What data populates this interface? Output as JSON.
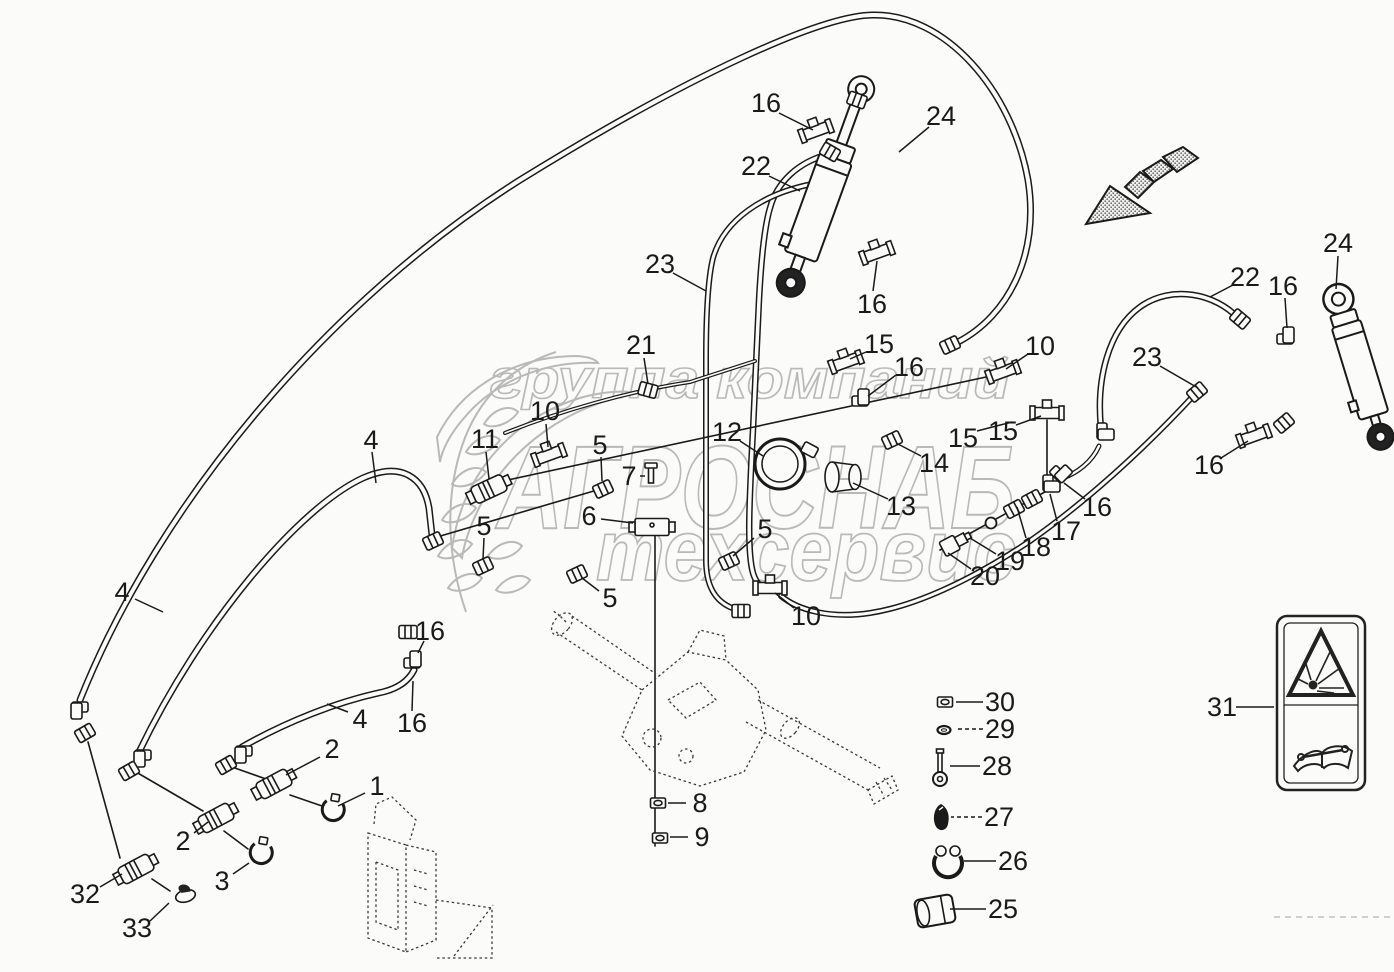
{
  "watermark": {
    "line1": "группа компаний",
    "line2": "АГРОСНАБ",
    "line3": "техсервис"
  },
  "colors": {
    "line": "#1a1a1a",
    "watermark": "#b9b9b6",
    "background": "#fbfbf9",
    "reference_dash": "#3a3a3a"
  },
  "icons": {
    "direction_arrow": "striped-direction-arrow",
    "sticker_top": "explosion-warning-triangle",
    "sticker_bottom": "read-operator-manual-book"
  },
  "callouts": [
    {
      "n": "16",
      "x": 766,
      "y": 103,
      "lx1": 779,
      "ly1": 113,
      "lx2": 813,
      "ly2": 130
    },
    {
      "n": "24",
      "x": 941,
      "y": 116,
      "lx1": 929,
      "ly1": 127,
      "lx2": 899,
      "ly2": 152
    },
    {
      "n": "22",
      "x": 756,
      "y": 166,
      "lx1": 769,
      "ly1": 176,
      "lx2": 800,
      "ly2": 191
    },
    {
      "n": "16",
      "x": 872,
      "y": 304,
      "lx1": 873,
      "ly1": 291,
      "lx2": 877,
      "ly2": 261
    },
    {
      "n": "23",
      "x": 660,
      "y": 264,
      "lx1": 673,
      "ly1": 273,
      "lx2": 706,
      "ly2": 291
    },
    {
      "n": "21",
      "x": 641,
      "y": 345,
      "lx1": 644,
      "ly1": 358,
      "lx2": 648,
      "ly2": 384
    },
    {
      "n": "24",
      "x": 1338,
      "y": 243,
      "lx1": 1338,
      "ly1": 256,
      "lx2": 1336,
      "ly2": 289
    },
    {
      "n": "22",
      "x": 1245,
      "y": 277,
      "lx1": 1233,
      "ly1": 285,
      "lx2": 1210,
      "ly2": 297
    },
    {
      "n": "16",
      "x": 1283,
      "y": 286,
      "lx1": 1285,
      "ly1": 298,
      "lx2": 1287,
      "ly2": 328
    },
    {
      "n": "23",
      "x": 1147,
      "y": 357,
      "lx1": 1160,
      "ly1": 366,
      "lx2": 1198,
      "ly2": 388
    },
    {
      "n": "16",
      "x": 1209,
      "y": 465,
      "lx1": 1221,
      "ly1": 458,
      "lx2": 1248,
      "ly2": 441
    },
    {
      "n": "15",
      "x": 879,
      "y": 344,
      "lx1": 866,
      "ly1": 352,
      "lx2": 850,
      "ly2": 359
    },
    {
      "n": "16",
      "x": 909,
      "y": 367,
      "lx1": 896,
      "ly1": 375,
      "lx2": 868,
      "ly2": 396
    },
    {
      "n": "10",
      "x": 1040,
      "y": 346,
      "lx1": 1028,
      "ly1": 354,
      "lx2": 1006,
      "ly2": 369
    },
    {
      "n": "15",
      "x": 963,
      "y": 438,
      "lx1": 977,
      "ly1": 431,
      "lx2": 1012,
      "ly2": 422
    },
    {
      "n": "15",
      "x": 1003,
      "y": 431,
      "lx1": 1016,
      "ly1": 425,
      "lx2": 1041,
      "ly2": 416
    },
    {
      "n": "14",
      "x": 934,
      "y": 463,
      "lx1": 921,
      "ly1": 456,
      "lx2": 896,
      "ly2": 443
    },
    {
      "n": "13",
      "x": 901,
      "y": 506,
      "lx1": 888,
      "ly1": 499,
      "lx2": 853,
      "ly2": 483
    },
    {
      "n": "12",
      "x": 727,
      "y": 432,
      "lx1": 740,
      "ly1": 441,
      "lx2": 763,
      "ly2": 456
    },
    {
      "n": "5",
      "x": 765,
      "y": 529,
      "lx1": 754,
      "ly1": 538,
      "lx2": 733,
      "ly2": 556
    },
    {
      "n": "10",
      "x": 806,
      "y": 616,
      "lx1": 794,
      "ly1": 608,
      "lx2": 775,
      "ly2": 593
    },
    {
      "n": "17",
      "x": 1066,
      "y": 531,
      "lx1": 1057,
      "ly1": 521,
      "lx2": 1050,
      "ly2": 494
    },
    {
      "n": "18",
      "x": 1036,
      "y": 547,
      "lx1": 1026,
      "ly1": 538,
      "lx2": 1017,
      "ly2": 507
    },
    {
      "n": "19",
      "x": 1010,
      "y": 561,
      "lx1": 996,
      "ly1": 554,
      "lx2": 970,
      "ly2": 538
    },
    {
      "n": "20",
      "x": 985,
      "y": 576,
      "lx1": 971,
      "ly1": 569,
      "lx2": 948,
      "ly2": 553
    },
    {
      "n": "16",
      "x": 1097,
      "y": 507,
      "lx1": 1085,
      "ly1": 499,
      "lx2": 1064,
      "ly2": 483
    },
    {
      "n": "11",
      "x": 485,
      "y": 439,
      "lx1": 486,
      "ly1": 452,
      "lx2": 489,
      "ly2": 479
    },
    {
      "n": "10",
      "x": 545,
      "y": 411,
      "lx1": 546,
      "ly1": 424,
      "lx2": 548,
      "ly2": 447
    },
    {
      "n": "5",
      "x": 600,
      "y": 445,
      "lx1": 601,
      "ly1": 457,
      "lx2": 602,
      "ly2": 481
    },
    {
      "n": "7",
      "x": 629,
      "y": 476,
      "lx1": 640,
      "ly1": 476,
      "lx2": 645,
      "ly2": 476
    },
    {
      "n": "6",
      "x": 589,
      "y": 516,
      "lx1": 601,
      "ly1": 519,
      "lx2": 633,
      "ly2": 523
    },
    {
      "n": "5",
      "x": 610,
      "y": 598,
      "lx1": 599,
      "ly1": 591,
      "lx2": 582,
      "ly2": 578
    },
    {
      "n": "5",
      "x": 484,
      "y": 526,
      "lx1": 484,
      "ly1": 538,
      "lx2": 483,
      "ly2": 559
    },
    {
      "n": "16",
      "x": 430,
      "y": 631,
      "lx1": 424,
      "ly1": 641,
      "lx2": 418,
      "ly2": 653
    },
    {
      "n": "16",
      "x": 412,
      "y": 723,
      "lx1": 412,
      "ly1": 711,
      "lx2": 413,
      "ly2": 681
    },
    {
      "n": "4",
      "x": 371,
      "y": 440,
      "lx1": 372,
      "ly1": 452,
      "lx2": 376,
      "ly2": 483
    },
    {
      "n": "4",
      "x": 122,
      "y": 592,
      "lx1": 135,
      "ly1": 599,
      "lx2": 163,
      "ly2": 612
    },
    {
      "n": "4",
      "x": 360,
      "y": 719,
      "lx1": 348,
      "ly1": 712,
      "lx2": 327,
      "ly2": 704
    },
    {
      "n": "2",
      "x": 332,
      "y": 749,
      "lx1": 320,
      "ly1": 757,
      "lx2": 286,
      "ly2": 775
    },
    {
      "n": "1",
      "x": 377,
      "y": 786,
      "lx1": 365,
      "ly1": 793,
      "lx2": 338,
      "ly2": 806
    },
    {
      "n": "2",
      "x": 183,
      "y": 841,
      "lx1": 194,
      "ly1": 833,
      "lx2": 208,
      "ly2": 822
    },
    {
      "n": "32",
      "x": 85,
      "y": 894,
      "lx1": 100,
      "ly1": 887,
      "lx2": 122,
      "ly2": 874
    },
    {
      "n": "33",
      "x": 137,
      "y": 928,
      "lx1": 150,
      "ly1": 921,
      "lx2": 169,
      "ly2": 903
    },
    {
      "n": "3",
      "x": 222,
      "y": 881,
      "lx1": 233,
      "ly1": 874,
      "lx2": 249,
      "ly2": 863
    },
    {
      "n": "8",
      "x": 700,
      "y": 803,
      "lx1": 686,
      "ly1": 803,
      "lx2": 668,
      "ly2": 803
    },
    {
      "n": "9",
      "x": 702,
      "y": 837,
      "lx1": 688,
      "ly1": 837,
      "lx2": 670,
      "ly2": 837
    },
    {
      "n": "30",
      "x": 1000,
      "y": 702,
      "lx1": 983,
      "ly1": 702,
      "lx2": 956,
      "ly2": 702
    },
    {
      "n": "29",
      "x": 1000,
      "y": 729,
      "lx1": 983,
      "ly1": 729,
      "lx2": 955,
      "ly2": 729,
      "dash": true
    },
    {
      "n": "28",
      "x": 997,
      "y": 766,
      "lx1": 980,
      "ly1": 766,
      "lx2": 950,
      "ly2": 766
    },
    {
      "n": "27",
      "x": 999,
      "y": 817,
      "lx1": 982,
      "ly1": 817,
      "lx2": 951,
      "ly2": 817,
      "dash": true
    },
    {
      "n": "26",
      "x": 1013,
      "y": 861,
      "lx1": 996,
      "ly1": 861,
      "lx2": 964,
      "ly2": 861
    },
    {
      "n": "25",
      "x": 1003,
      "y": 909,
      "lx1": 986,
      "ly1": 909,
      "lx2": 950,
      "ly2": 909
    },
    {
      "n": "31",
      "x": 1222,
      "y": 707,
      "lx1": 1236,
      "ly1": 707,
      "lx2": 1274,
      "ly2": 707
    }
  ],
  "parts": [
    {
      "t": "fit",
      "x": 816,
      "y": 131,
      "r": -20
    },
    {
      "t": "nut",
      "x": 857,
      "y": 100,
      "r": 20
    },
    {
      "t": "fit",
      "x": 877,
      "y": 253,
      "r": -20
    },
    {
      "t": "nut",
      "x": 830,
      "y": 152,
      "r": 30
    },
    {
      "t": "nut",
      "x": 648,
      "y": 390,
      "r": 15
    },
    {
      "t": "fit",
      "x": 846,
      "y": 362,
      "r": -20
    },
    {
      "t": "elbow",
      "x": 864,
      "y": 401,
      "r": 0
    },
    {
      "t": "nut",
      "x": 892,
      "y": 440,
      "r": -25
    },
    {
      "t": "fit",
      "x": 1003,
      "y": 372,
      "r": -20
    },
    {
      "t": "nut",
      "x": 950,
      "y": 345,
      "r": -25
    },
    {
      "t": "fit",
      "x": 1047,
      "y": 413,
      "r": 0
    },
    {
      "t": "elbow",
      "x": 1048,
      "y": 487,
      "r": 90
    },
    {
      "t": "nut",
      "x": 1032,
      "y": 499,
      "r": -28
    },
    {
      "t": "nut",
      "x": 1014,
      "y": 509,
      "r": -28
    },
    {
      "t": "ring",
      "x": 991,
      "y": 523,
      "r": 0
    },
    {
      "t": "sensor",
      "x": 955,
      "y": 543,
      "r": -28
    },
    {
      "t": "elbow",
      "x": 1061,
      "y": 477,
      "r": 45
    },
    {
      "t": "cap",
      "x": 843,
      "y": 477,
      "r": 0
    },
    {
      "t": "clampring",
      "x": 780,
      "y": 464,
      "r": 0
    },
    {
      "t": "nut",
      "x": 729,
      "y": 561,
      "r": -25
    },
    {
      "t": "fit",
      "x": 770,
      "y": 588,
      "r": 0
    },
    {
      "t": "nut",
      "x": 741,
      "y": 611,
      "r": 0
    },
    {
      "t": "nut",
      "x": 603,
      "y": 489,
      "r": -25
    },
    {
      "t": "bolt",
      "x": 651,
      "y": 475,
      "r": 0
    },
    {
      "t": "block",
      "x": 652,
      "y": 527,
      "r": 0
    },
    {
      "t": "nut",
      "x": 577,
      "y": 574,
      "r": -25
    },
    {
      "t": "nut",
      "x": 483,
      "y": 566,
      "r": -25
    },
    {
      "t": "nut",
      "x": 433,
      "y": 541,
      "r": -25
    },
    {
      "t": "elbow",
      "x": 416,
      "y": 663,
      "r": 0
    },
    {
      "t": "nut",
      "x": 408,
      "y": 632,
      "r": 0
    },
    {
      "t": "coupler",
      "x": 489,
      "y": 489,
      "r": -25
    },
    {
      "t": "fit",
      "x": 549,
      "y": 455,
      "r": -20
    },
    {
      "t": "elbow",
      "x": 76,
      "y": 707,
      "r": 180
    },
    {
      "t": "nut",
      "x": 85,
      "y": 733,
      "r": -30
    },
    {
      "t": "elbow",
      "x": 139,
      "y": 755,
      "r": 180
    },
    {
      "t": "nut",
      "x": 129,
      "y": 771,
      "r": -30
    },
    {
      "t": "elbow",
      "x": 240,
      "y": 751,
      "r": 180
    },
    {
      "t": "nut",
      "x": 226,
      "y": 765,
      "r": -30
    },
    {
      "t": "coupler",
      "x": 274,
      "y": 784,
      "r": -28
    },
    {
      "t": "coupler",
      "x": 216,
      "y": 818,
      "r": -28
    },
    {
      "t": "clamp",
      "x": 333,
      "y": 811,
      "r": 10
    },
    {
      "t": "clamp",
      "x": 261,
      "y": 854,
      "r": 10
    },
    {
      "t": "coupler",
      "x": 136,
      "y": 869,
      "r": -28
    },
    {
      "t": "cap33",
      "x": 185,
      "y": 894,
      "r": -15
    },
    {
      "t": "nut",
      "x": 1240,
      "y": 319,
      "r": 40
    },
    {
      "t": "elbow",
      "x": 1289,
      "y": 339,
      "r": 0
    },
    {
      "t": "elbow",
      "x": 1102,
      "y": 435,
      "r": 90
    },
    {
      "t": "nut",
      "x": 1197,
      "y": 392,
      "r": -40
    },
    {
      "t": "fit",
      "x": 1254,
      "y": 436,
      "r": -20
    },
    {
      "t": "nut",
      "x": 1284,
      "y": 423,
      "r": -40
    },
    {
      "t": "hexnut",
      "x": 658,
      "y": 803,
      "r": 0
    },
    {
      "t": "hexnut",
      "x": 660,
      "y": 838,
      "r": 0
    },
    {
      "t": "hexnut",
      "x": 945,
      "y": 702,
      "r": 0
    },
    {
      "t": "oring",
      "x": 944,
      "y": 730,
      "r": 0
    },
    {
      "t": "bolt28",
      "x": 940,
      "y": 768,
      "r": 0
    },
    {
      "t": "plug",
      "x": 941,
      "y": 818,
      "r": 0
    },
    {
      "t": "clamp26",
      "x": 948,
      "y": 863,
      "r": 0
    },
    {
      "t": "sleeve",
      "x": 935,
      "y": 911,
      "r": -10
    }
  ]
}
